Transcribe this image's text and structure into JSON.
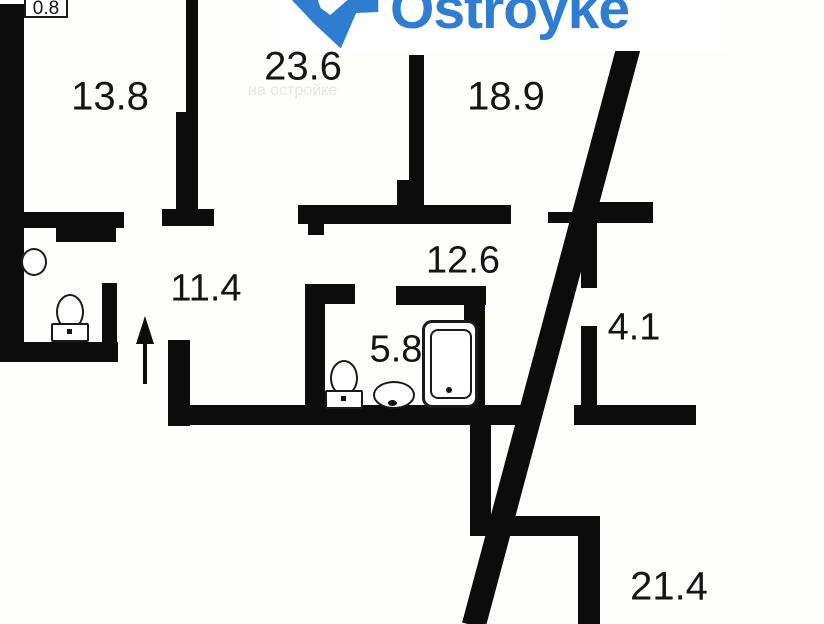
{
  "logo": {
    "text": "Ostroyke",
    "color": "#2e7dd1",
    "icon": "map-pin-icon"
  },
  "watermark": {
    "ghost_text": "на остройке"
  },
  "floorplan": {
    "rooms": [
      {
        "name": "balcony",
        "area": "0.8"
      },
      {
        "name": "room-top-left",
        "area": "13.8"
      },
      {
        "name": "room-top-center",
        "area": "23.6"
      },
      {
        "name": "room-top-right",
        "area": "18.9"
      },
      {
        "name": "corridor",
        "area": "12.6"
      },
      {
        "name": "hallway",
        "area": "11.4"
      },
      {
        "name": "storage",
        "area": "4.1"
      },
      {
        "name": "bathroom",
        "area": "5.8"
      },
      {
        "name": "room-bottom-right",
        "area": "21.4"
      }
    ],
    "fixtures": [
      "toilet",
      "round-sink",
      "toilet",
      "sink",
      "bathtub"
    ],
    "entrance_icon": "arrow-up-icon",
    "colors": {
      "wall": "#0c0c0c",
      "label": "#141414",
      "logo_blue": "#2e7dd1"
    }
  }
}
